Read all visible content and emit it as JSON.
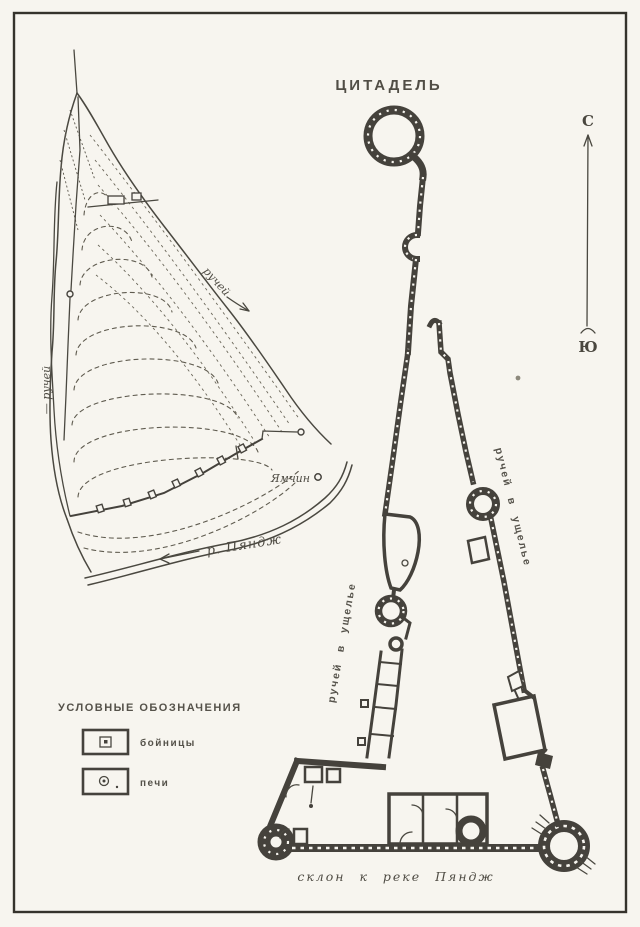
{
  "figure": {
    "title": "ЦИТАДЕЛЬ",
    "compass": {
      "north": "С",
      "south": "Ю"
    },
    "topo": {
      "stream_left": "— ручей",
      "stream_right": "ручей",
      "settlement": "Ямчин",
      "river": "р. Пяндж"
    },
    "plan": {
      "gorge_left": "ручей в ущелье",
      "gorge_right": "ручей в ущелье",
      "slope": "склон к реке Пяндж"
    },
    "legend": {
      "heading": "УСЛОВНЫЕ ОБОЗНАЧЕНИЯ",
      "items": [
        {
          "icon": "loophole-icon",
          "label": "бойницы"
        },
        {
          "icon": "oven-icon",
          "label": "печи"
        }
      ]
    },
    "colors": {
      "ink": "#45423c",
      "paper": "#f7f5ef"
    }
  }
}
